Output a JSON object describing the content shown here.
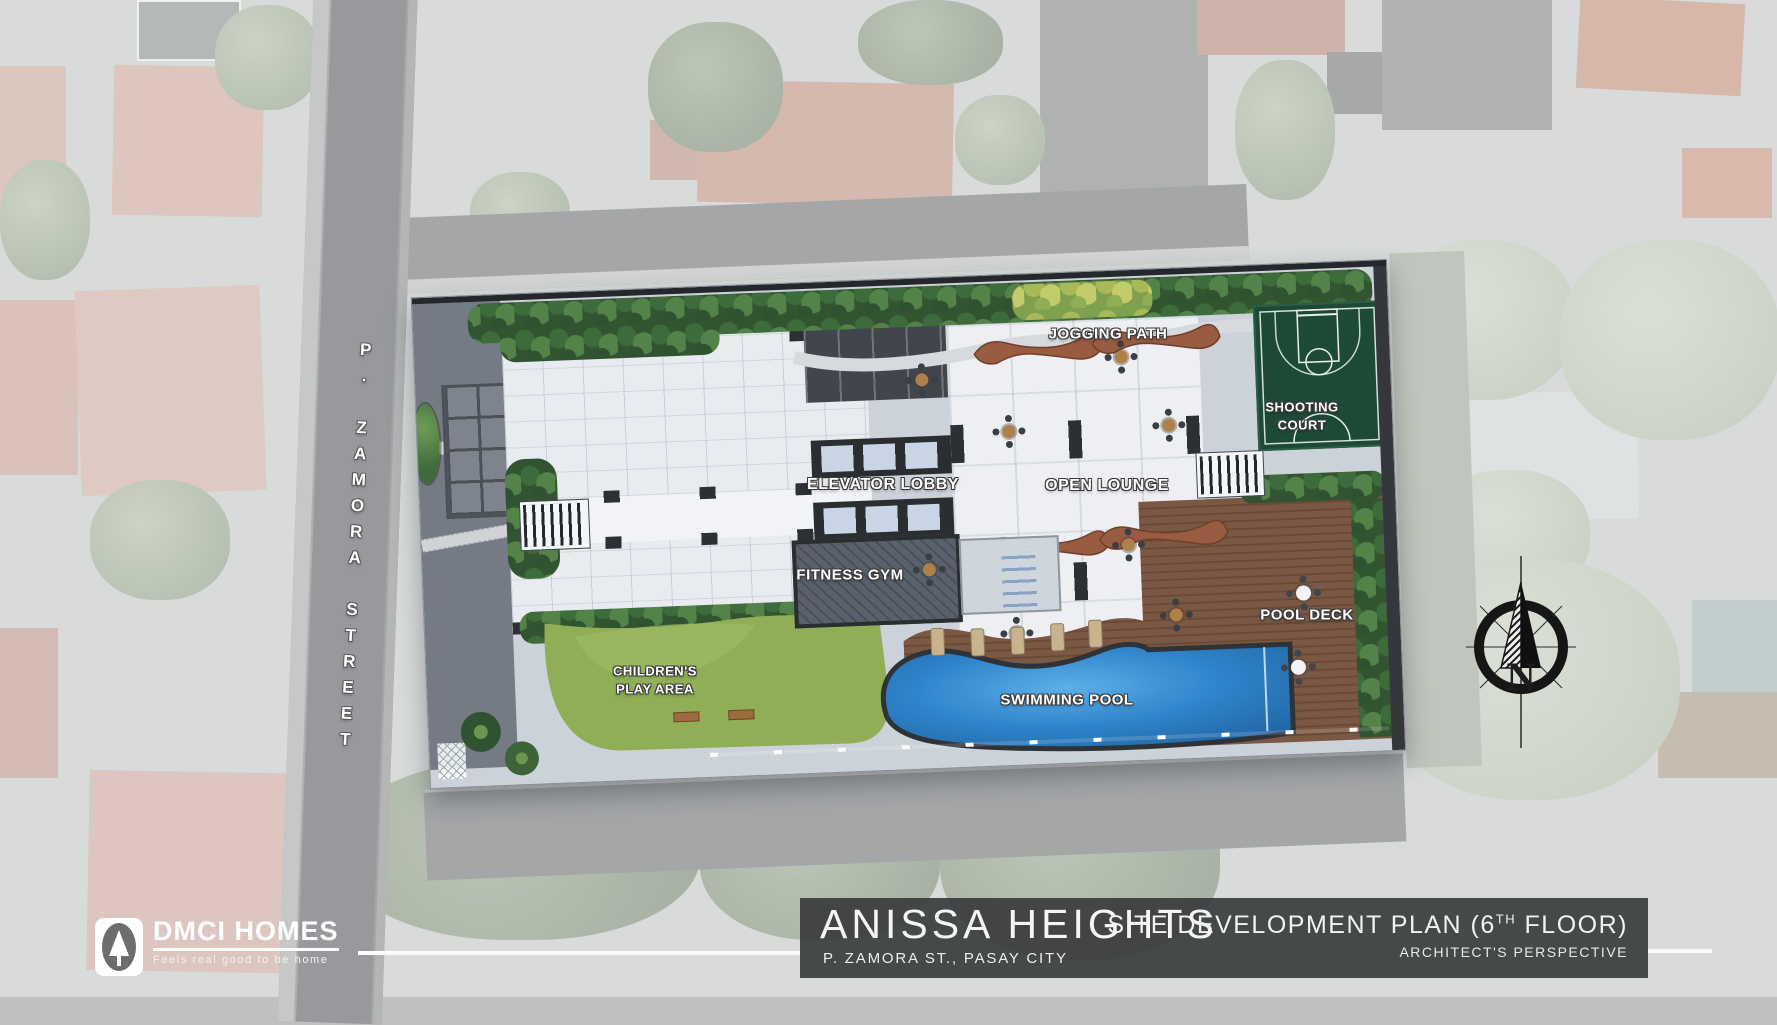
{
  "plan": {
    "street_label": "P. ZAMORA STREET",
    "labels": {
      "jogging_path": "JOGGING PATH",
      "shooting_court_line1": "SHOOTING",
      "shooting_court_line2": "COURT",
      "elevator_lobby": "ELEVATOR LOBBY",
      "open_lounge": "OPEN LOUNGE",
      "fitness_gym": "FITNESS GYM",
      "pool_deck": "POOL DECK",
      "childrens_play_line1": "CHILDREN'S",
      "childrens_play_line2": "PLAY AREA",
      "swimming_pool": "SWIMMING POOL"
    },
    "compass": {
      "north_label": "N"
    }
  },
  "footer": {
    "logo": {
      "brand": "DMCI HOMES",
      "tagline": "Feels real good to be home"
    },
    "project_name": "ANISSA HEIGHTS",
    "project_address": "P. ZAMORA ST., PASAY CITY",
    "plan_title_prefix": "SITE DEVELOPMENT PLAN (6",
    "plan_title_sup": "TH",
    "plan_title_suffix": " FLOOR)",
    "plan_subtitle": "ARCHITECT'S PERSPECTIVE"
  },
  "colors": {
    "pool_water": "#2f83c9",
    "court_green": "#1d4a37",
    "deck_wood": "#7b5843",
    "lawn_green": "#8fae55",
    "footer_bar": "#363938"
  }
}
